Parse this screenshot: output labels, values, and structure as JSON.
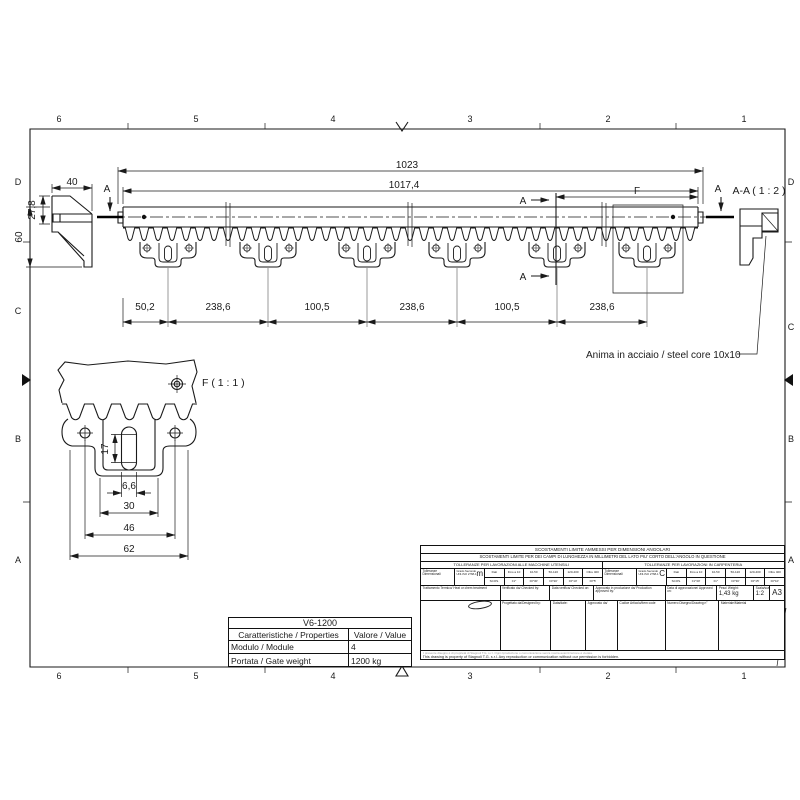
{
  "frame": {
    "cols": [
      "6",
      "5",
      "4",
      "3",
      "2",
      "1"
    ],
    "rows": [
      "D",
      "C",
      "B",
      "A"
    ]
  },
  "main_view": {
    "dim_total": "1023",
    "dim_body": "1017,4",
    "dim_spacings": [
      "50,2",
      "238,6",
      "100,5",
      "238,6",
      "100,5",
      "238,6"
    ],
    "section_letter": "A",
    "detail_letter": "F"
  },
  "side_view": {
    "dim_width": "40",
    "dim_offset": "27,8",
    "dim_height": "60"
  },
  "section_view": {
    "label": "A-A ( 1 : 2 )"
  },
  "detail_view": {
    "label": "F ( 1 : 1 )",
    "dim_slot_len": "17",
    "dim_slot_w": "6,6",
    "dim_30": "30",
    "dim_46": "46",
    "dim_62": "62"
  },
  "note_steel_core": "Anima in acciaio / steel core 10x10",
  "properties": {
    "model": "V6-1200",
    "col_properties": "Caratteristiche / Properties",
    "col_value": "Valore / Value",
    "rows": [
      {
        "k": "Modulo / Module",
        "v": "4"
      },
      {
        "k": "Portata / Gate weight",
        "v": "1200 kg"
      }
    ]
  },
  "title_block": {
    "row1": "SCOSTAMENTI LIMITE AMMESSI PER DIMENSIONI ANGOLARI",
    "row2": "SCOSTAMENTI LIMITE PER DEI CAMPI DI LUNGHEZZA IN MILLIMETRI DEL LATO PIU' CORTO DELL'ANGOLO IN QUESTIONE",
    "mach_title": "TOLLERANZE PER LAVORAZIONI ALLE MACCHINE UTENSILI",
    "carp_title": "TOLLERANZE PER LAVORAZIONI IN CARPENTERIA",
    "tol_label": "Tolleranze Dimensionali",
    "grade_label": "Grado Secondo UNI-ISO 2768-1",
    "grade_mach": "m",
    "grade_carp": "C",
    "dati": "Dati",
    "scos": "SCOS.",
    "ranges": [
      "Fino a 10",
      "10-50",
      "50-120",
      "120-400",
      "Oltre 400"
    ],
    "mach_vals": [
      "±1°",
      "±0°30'",
      "±0°20'",
      "±0°10'",
      "±0°5'"
    ],
    "carp_vals": [
      "±1°30'",
      "±1°",
      "±0°30'",
      "±0°15'",
      "±0°10'"
    ],
    "heat": "Trattamento Termico/ Heat or chem treatment",
    "checked_by": "Verificato da/ Checked by:",
    "checked_on": "Data verifica/ Checked on:",
    "prod_approved": "Approvato in produzione da/ Production approved by:",
    "approved_on": "Data di approvazione/ Approved on:",
    "weight_label": "Peso/ Weight:",
    "weight_value": "1,43 kg",
    "scale_label": "Scala/scale:",
    "scale_value": "1:2",
    "sheet_format": "A3",
    "designed_by": "Progettato da/Designed by:",
    "date_label": "Data/date:",
    "approved_by": "Approvato da/",
    "item_code": "Codice Articolo/Item code",
    "drawing_n": "Numero Disegno/Drawing n°",
    "material": "Materiale/Material",
    "notice_it": "Il presente disegno è di proprietà di Stagnoli T.G. s.r.l. Ogni riproduzione o comunicazione senza nostra autorizzazione è vietata.",
    "notice_en": "This drawing is property of Stagnoli T.G. s.r.l. Any reproduction or communication without our permission is forbidden."
  }
}
